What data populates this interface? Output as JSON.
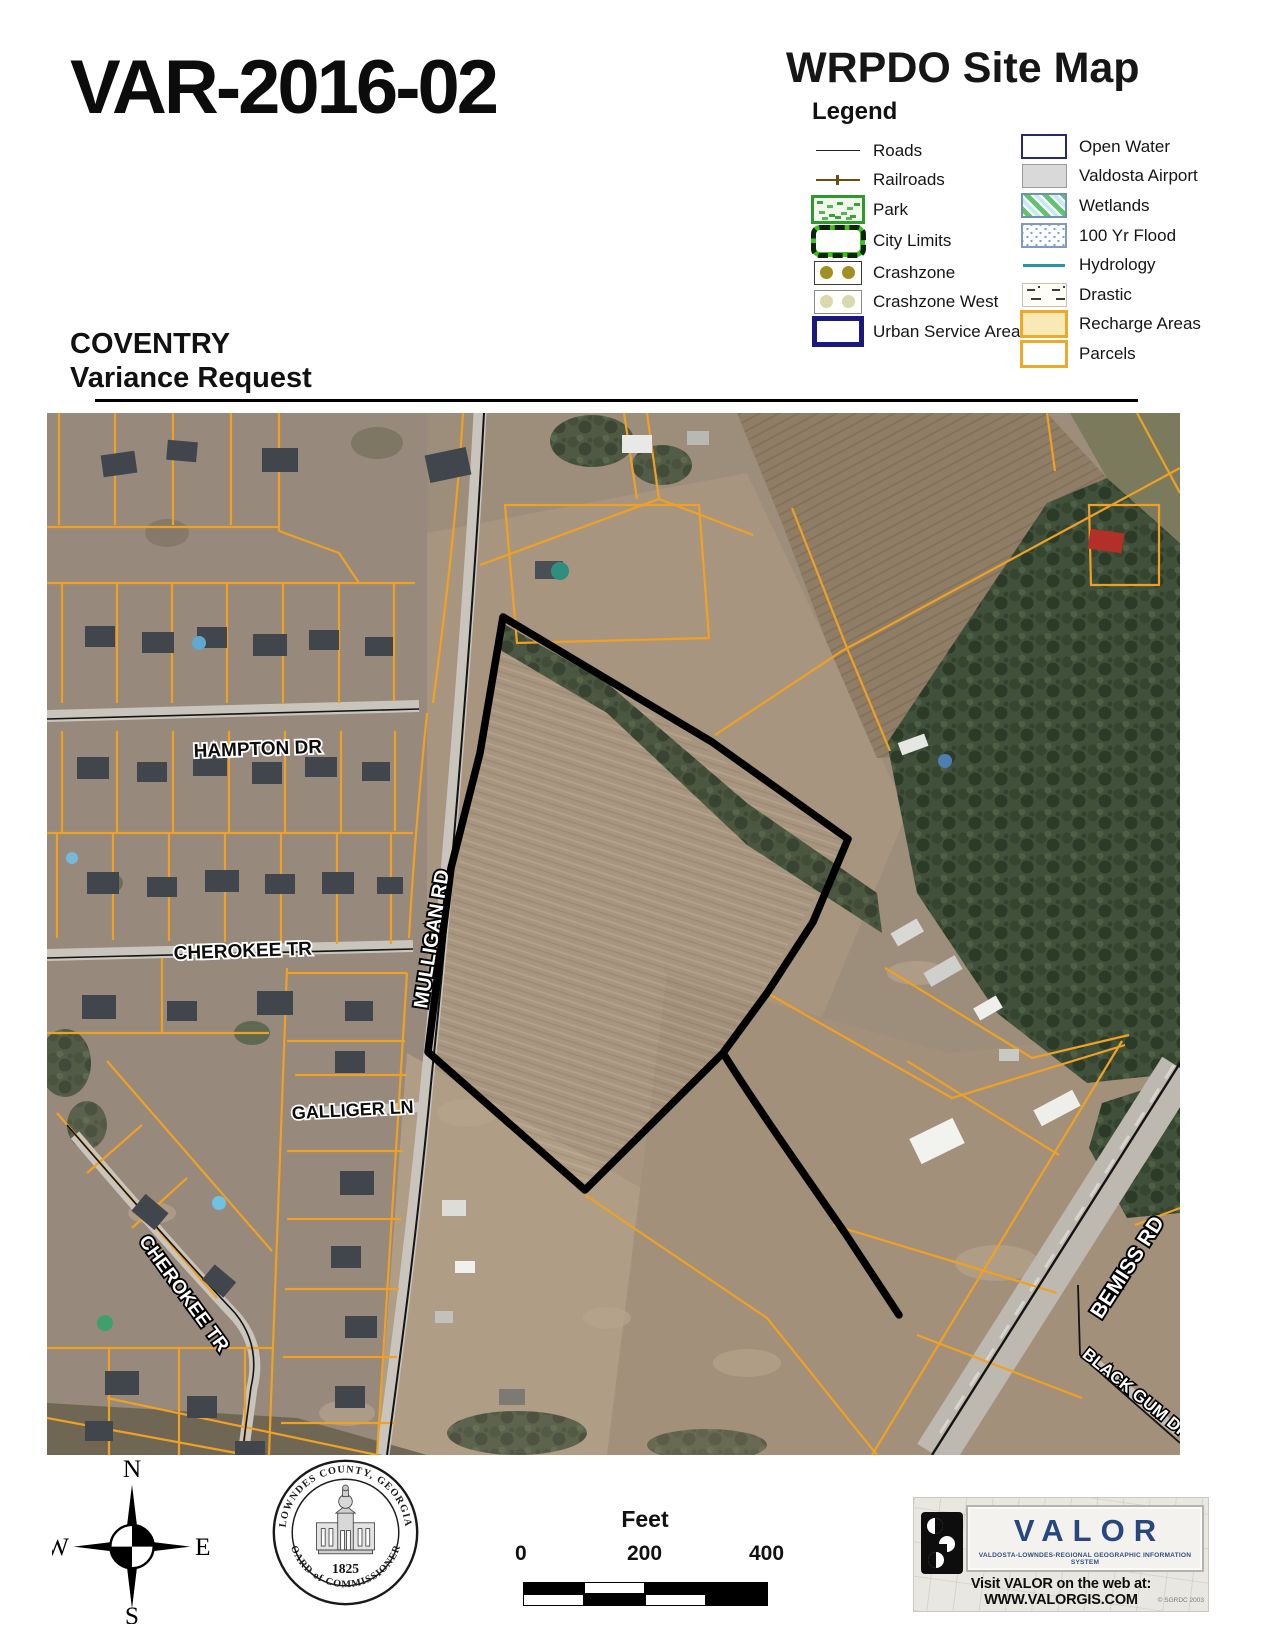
{
  "header": {
    "case_number": "VAR-2016-02",
    "map_title": "WRPDO Site Map",
    "legend_title": "Legend",
    "subtitle_line1": "COVENTRY",
    "subtitle_line2": "Variance Request"
  },
  "legend": {
    "left": [
      {
        "label": "Roads"
      },
      {
        "label": "Railroads"
      },
      {
        "label": "Park"
      },
      {
        "label": "City Limits"
      },
      {
        "label": "Crashzone"
      },
      {
        "label": "Crashzone West"
      },
      {
        "label": "Urban Service Area"
      }
    ],
    "right": [
      {
        "label": "Open Water"
      },
      {
        "label": "Valdosta Airport"
      },
      {
        "label": "Wetlands"
      },
      {
        "label": "100 Yr Flood"
      },
      {
        "label": "Hydrology"
      },
      {
        "label": "Drastic"
      },
      {
        "label": "Recharge Areas"
      },
      {
        "label": "Parcels"
      }
    ]
  },
  "map": {
    "labels": {
      "hampton": "HAMPTON DR",
      "cherokee_upper": "CHEROKEE TR",
      "mulligan": "MULLIGAN RD",
      "galliger": "GALLIGER LN",
      "cherokee_lower": "CHEROKEE TR",
      "bemiss": "BEMISS RD",
      "black_gum": "BLACK GUM DR"
    }
  },
  "footer": {
    "compass": {
      "n": "N",
      "s": "S",
      "e": "E",
      "w": "W"
    },
    "seal": {
      "top": "LOWNDES COUNTY, GEORGIA",
      "bottom": "BOARD of COMMISSIONERS",
      "year": "1825"
    },
    "scalebar": {
      "title": "Feet",
      "ticks": [
        "0",
        "200",
        "400"
      ]
    },
    "valor": {
      "name": "VALOR",
      "subtitle": "VALDOSTA-LOWNDES-REGIONAL GEOGRAPHIC INFORMATION SYSTEM",
      "web": "Visit VALOR on the web at: WWW.VALORGIS.COM",
      "copyright": "© SGRDC 2003"
    }
  },
  "colors": {
    "parcel_line": "#EFA125",
    "subject_outline": "#000000",
    "forest": "#3C4A34",
    "field": "#A6937E",
    "valor_blue": "#27477E",
    "recharge_fill": "#F8E9B5"
  }
}
